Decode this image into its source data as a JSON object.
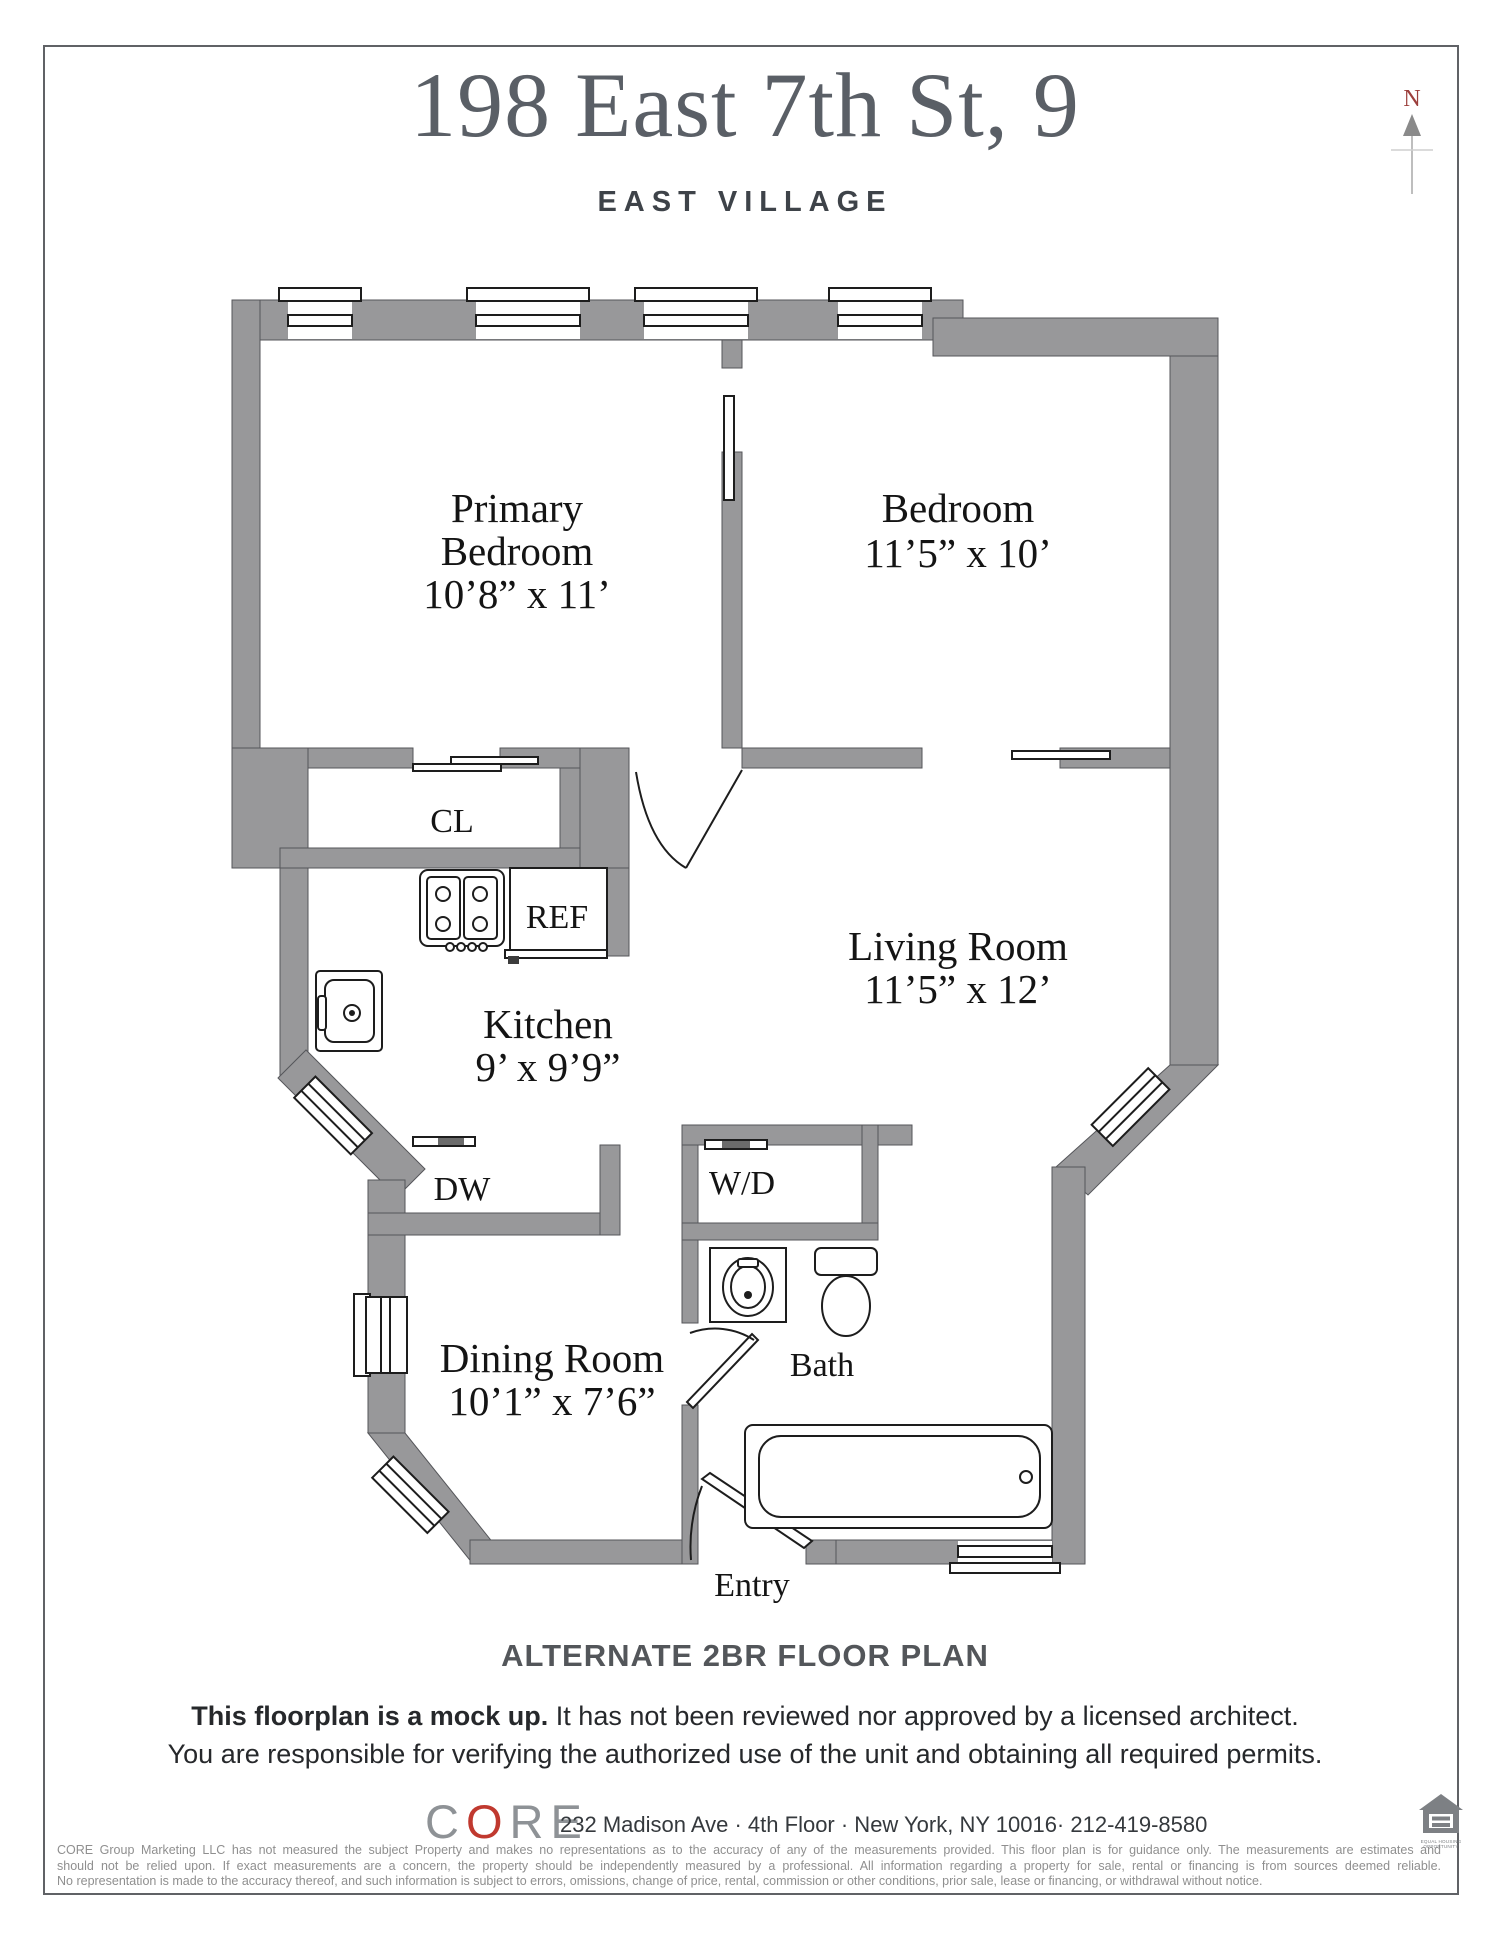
{
  "header": {
    "title": "198 East 7th St, 9",
    "subtitle": "EAST VILLAGE",
    "compass": "N"
  },
  "rooms": {
    "primary_bedroom": {
      "line1": "Primary",
      "line2": "Bedroom",
      "dims": "10’8” x 11’"
    },
    "bedroom": {
      "name": "Bedroom",
      "dims": "11’5” x 10’"
    },
    "living_room": {
      "name": "Living Room",
      "dims": "11’5” x 12’"
    },
    "kitchen": {
      "name": "Kitchen",
      "dims": "9’ x 9’9”"
    },
    "dining_room": {
      "name": "Dining Room",
      "dims": "10’1” x 7’6”"
    },
    "bath": {
      "name": "Bath"
    },
    "closet": "CL",
    "fridge": "REF",
    "dishwasher": "DW",
    "washer_dryer": "W/D",
    "entry": "Entry"
  },
  "footer": {
    "plan_type": "ALTERNATE 2BR FLOOR PLAN",
    "disclaimer_bold": "This floorplan is a mock up.",
    "disclaimer_rest": " It has not been reviewed nor approved by a licensed architect.",
    "disclaimer_line2": "You are responsible for verifying the authorized use of the unit and obtaining all required permits.",
    "brand": {
      "c": "C",
      "o": "O",
      "re": "RE"
    },
    "address": "232 Madison Ave · 4th Floor · New York, NY 10016· 212-419-8580",
    "legal_line1": "CORE Group Marketing LLC has not measured the subject Property and makes no representations as to the accuracy of any of the measurements provided. This floor plan is for guidance only. The measurements are estimates and",
    "legal_line2": "should not be relied upon. If exact measurements are a concern, the property should be independently measured by a professional. All information regarding a property for sale, rental or financing is from sources deemed reliable.",
    "legal_line3": "No representation is made to the accuracy thereof, and such information is subject to errors, omissions, change of price,  rental, commission or other conditions, prior sale, lease or financing, or withdrawal without notice.",
    "equal_housing": {
      "line1": "EQUAL HOUSING",
      "line2": "OPPORTUNITY"
    }
  },
  "colors": {
    "wall": "#98989a",
    "line": "#1d1d1d",
    "accent_red": "#9c3f3c",
    "brand_red": "#c0392f"
  }
}
